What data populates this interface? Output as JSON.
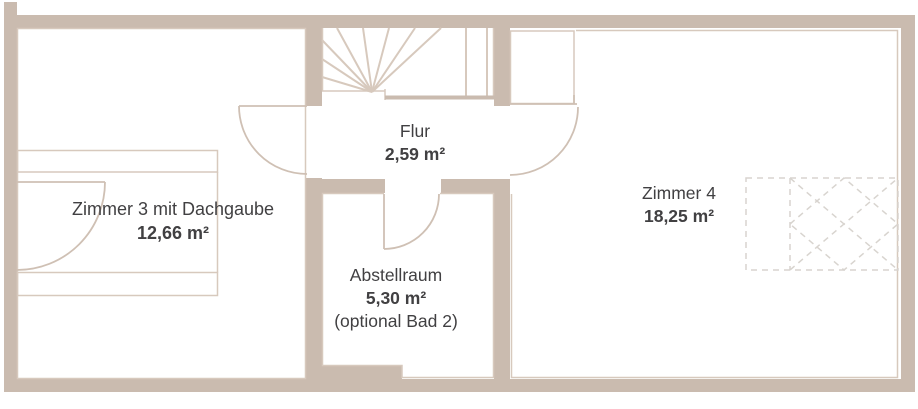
{
  "plan": {
    "title": "floor plan upper storey",
    "colors": {
      "bg": "#ffffff",
      "wall": "#cabbaf",
      "line": "#d7c9bd",
      "door": "#cfc0b4",
      "dash": "#d8d4cf",
      "text": "#414042"
    },
    "rooms": [
      {
        "id": "flur",
        "name": "Flur",
        "area": "2,59 m²"
      },
      {
        "id": "zimmer3",
        "name": "Zimmer 3 mit Dachgaube",
        "area": "12,66 m²"
      },
      {
        "id": "abstellraum",
        "name": "Abstellraum",
        "area": "5,30 m²",
        "note": "(optional Bad 2)"
      },
      {
        "id": "zimmer4",
        "name": "Zimmer 4",
        "area": "18,25 m²"
      }
    ]
  }
}
